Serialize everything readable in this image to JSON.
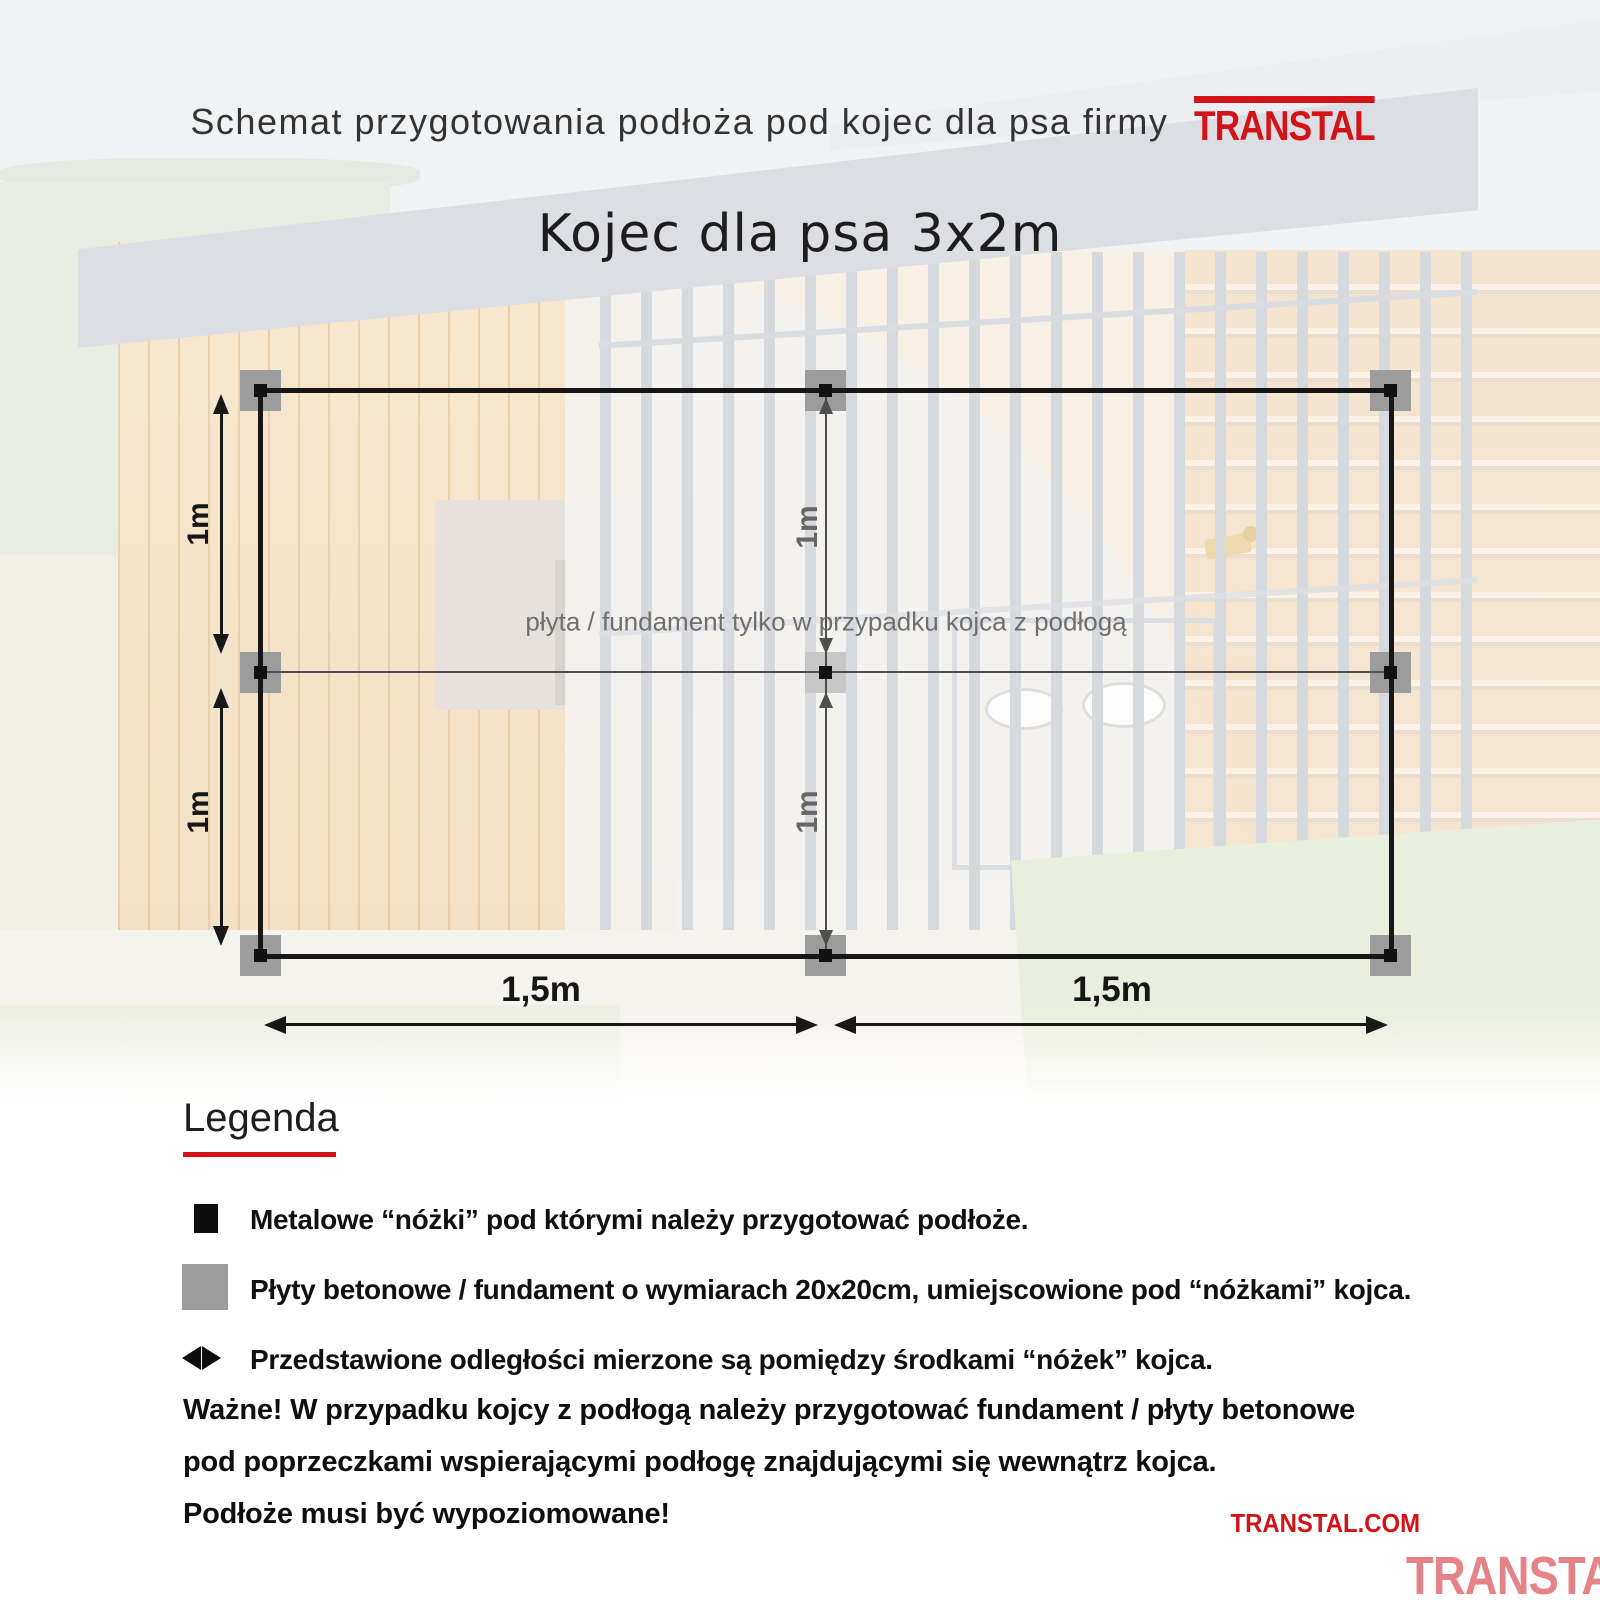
{
  "header": {
    "title": "Schemat przygotowania podłoża pod kojec dla psa firmy",
    "logo": "TranStal",
    "subtitle": "Kojec dla psa 3x2m"
  },
  "diagram": {
    "note": "płyta / fundament tylko w przypadku kojca z podłogą",
    "dims": {
      "left_top": "1m",
      "left_bottom": "1m",
      "mid_top": "1m",
      "mid_bottom": "1m",
      "bottom_left": "1,5m",
      "bottom_right": "1,5m"
    }
  },
  "legend": {
    "heading": "Legenda",
    "items": [
      {
        "icon": "black-square-icon",
        "text": "Metalowe “nóżki” pod którymi należy przygotować podłoże."
      },
      {
        "icon": "gray-square-icon",
        "text": "Płyty betonowe / fundament o wymiarach 20x20cm, umiejscowione pod “nóżkami” kojca."
      },
      {
        "icon": "double-arrow-icon",
        "text": "Przedstawione odległości mierzone są pomiędzy środkami “nóżek” kojca."
      }
    ],
    "important": {
      "label": "Ważne!",
      "line1": "W przypadku kojcy z podłogą należy przygotować fundament / płyty betonowe",
      "line2": "pod poprzeczkami wspierającymi podłogę znajdującymi się wewnątrz kojca.",
      "line3": "Podłoże musi być wypoziomowane!"
    }
  },
  "footer": {
    "website": "TRANSTAL.COM",
    "logo": "TranStal"
  },
  "colors": {
    "brand_red": "#d21318",
    "pad_gray": "#9c9c9c",
    "pad_center_gray": "#c7c7c7",
    "line_black": "#161616",
    "thin_line_gray": "#4d4d4d",
    "note_gray": "#6f6f6f"
  }
}
